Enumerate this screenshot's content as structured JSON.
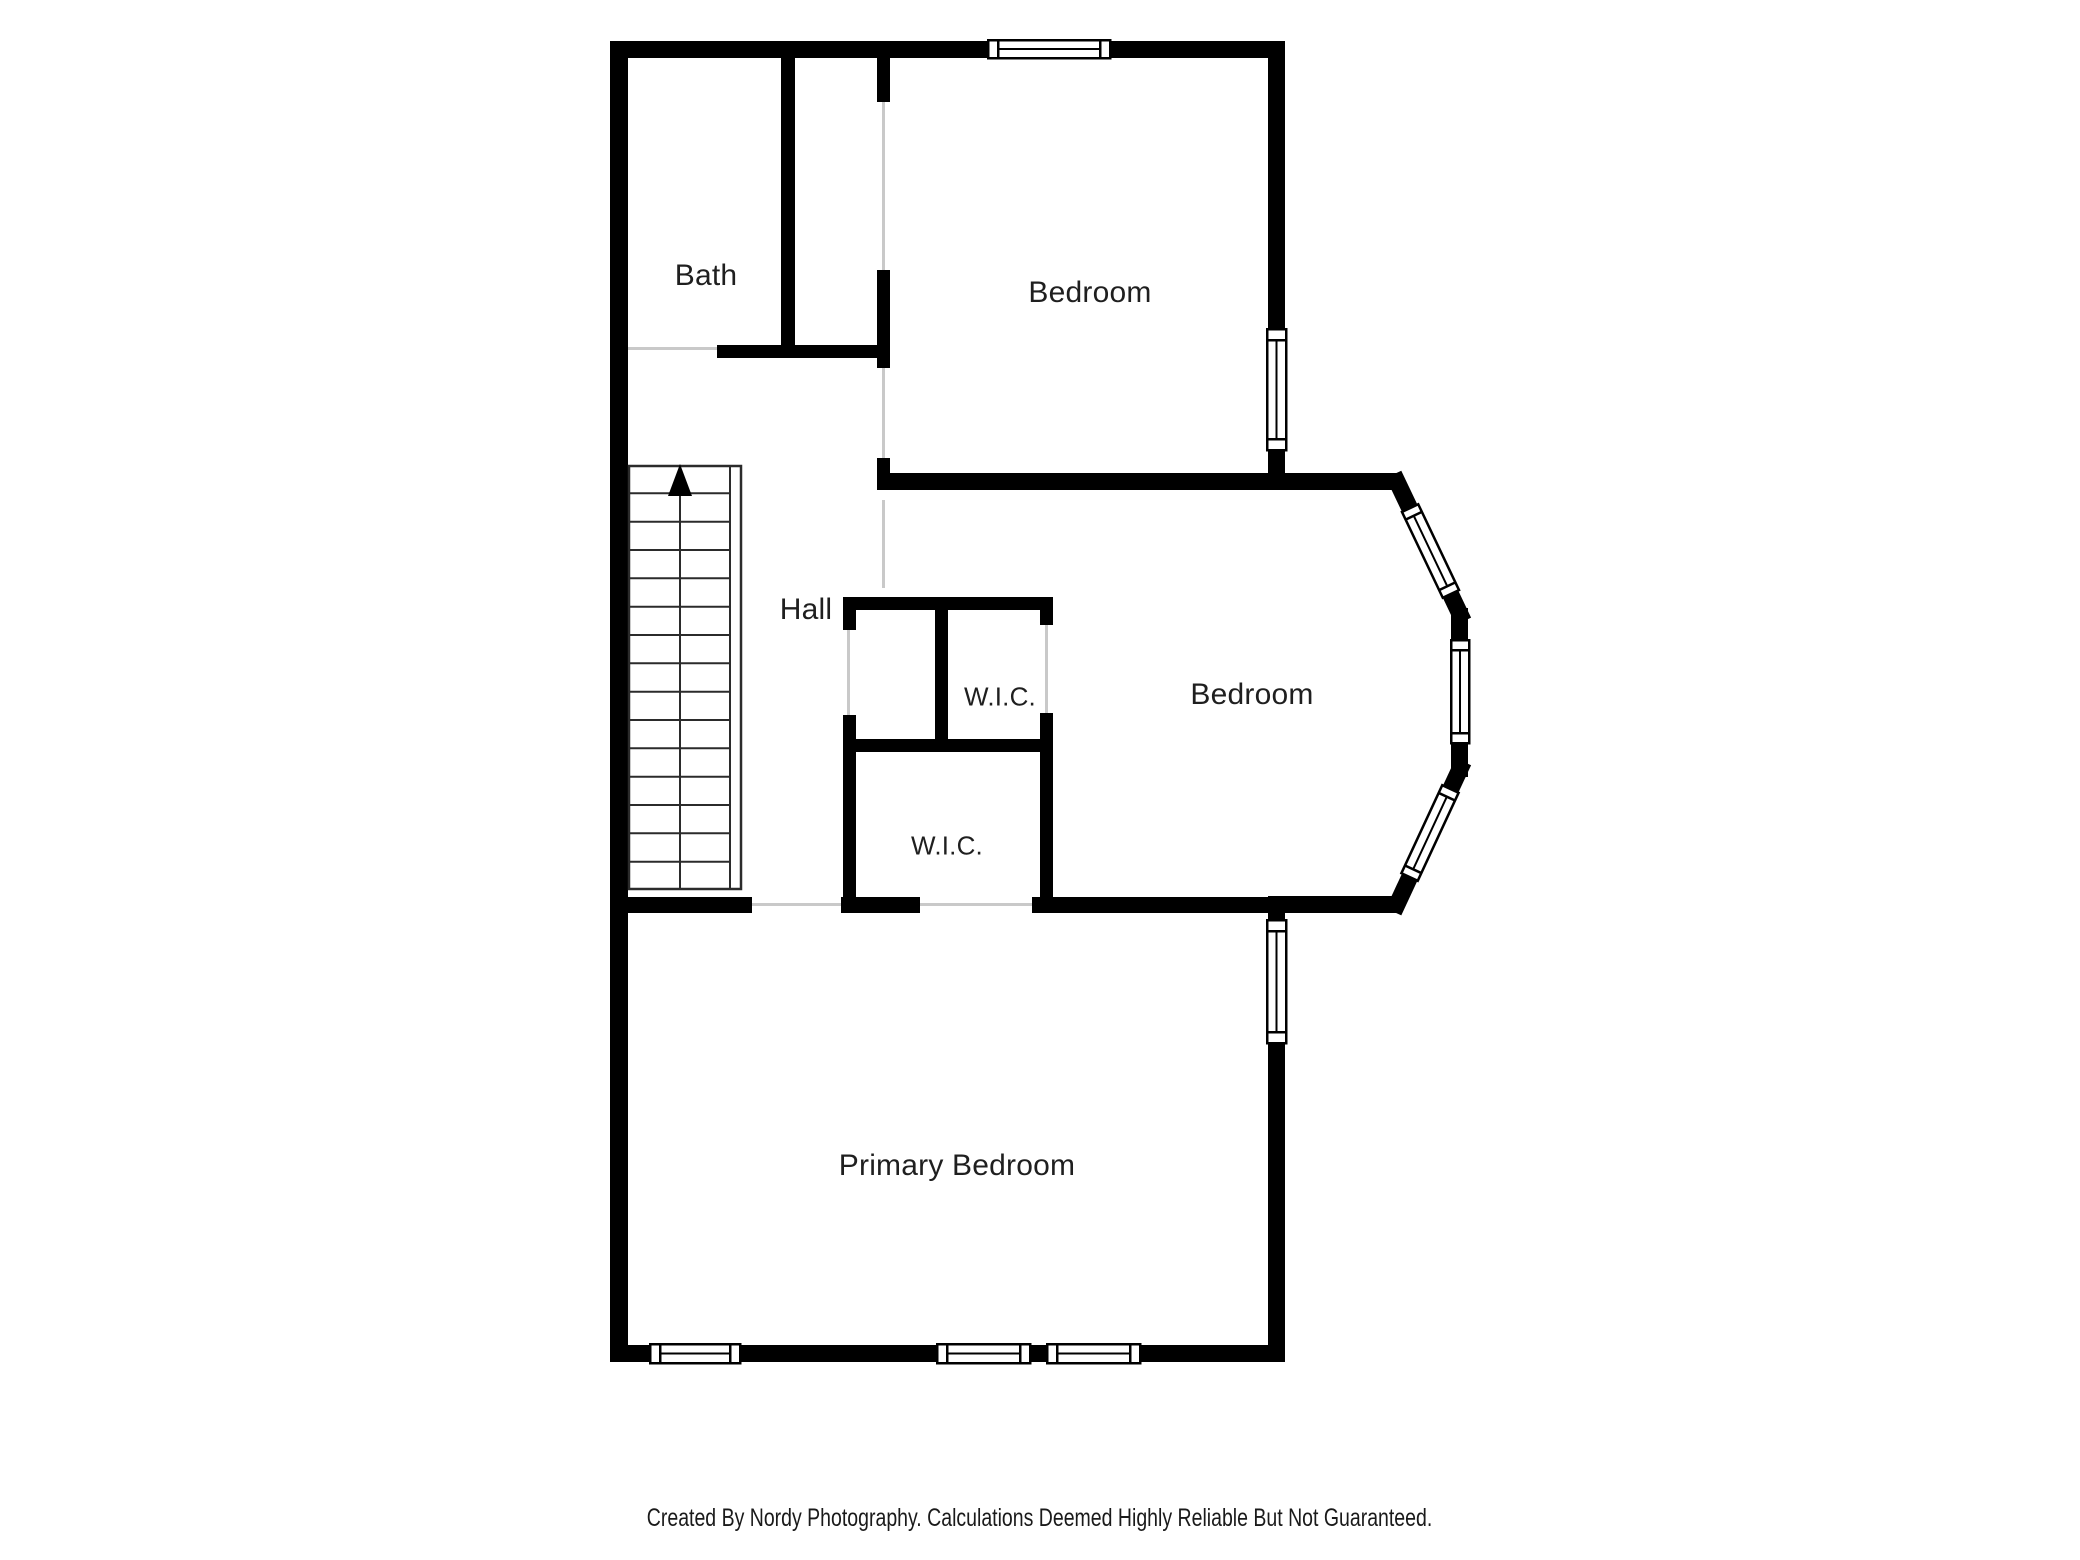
{
  "rooms": [
    {
      "id": "bath",
      "label": "Bath"
    },
    {
      "id": "bedroom-top",
      "label": "Bedroom"
    },
    {
      "id": "hall",
      "label": "Hall"
    },
    {
      "id": "wic-upper",
      "label": "W.I.C."
    },
    {
      "id": "bedroom-middle",
      "label": "Bedroom"
    },
    {
      "id": "wic-lower",
      "label": "W.I.C."
    },
    {
      "id": "primary-bedroom",
      "label": "Primary Bedroom"
    }
  ],
  "stairs": {
    "direction": "up",
    "treads": 15
  },
  "windows": {
    "count": 9
  },
  "footer": {
    "credit": "Created By Nordy Photography. Calculations Deemed Highly Reliable But Not Guaranteed."
  },
  "colors": {
    "wall": "#000000",
    "background": "#ffffff",
    "opening_line": "#c9c9c9",
    "stair_line": "#2b2b2b",
    "label_text": "#1f1f1f"
  }
}
